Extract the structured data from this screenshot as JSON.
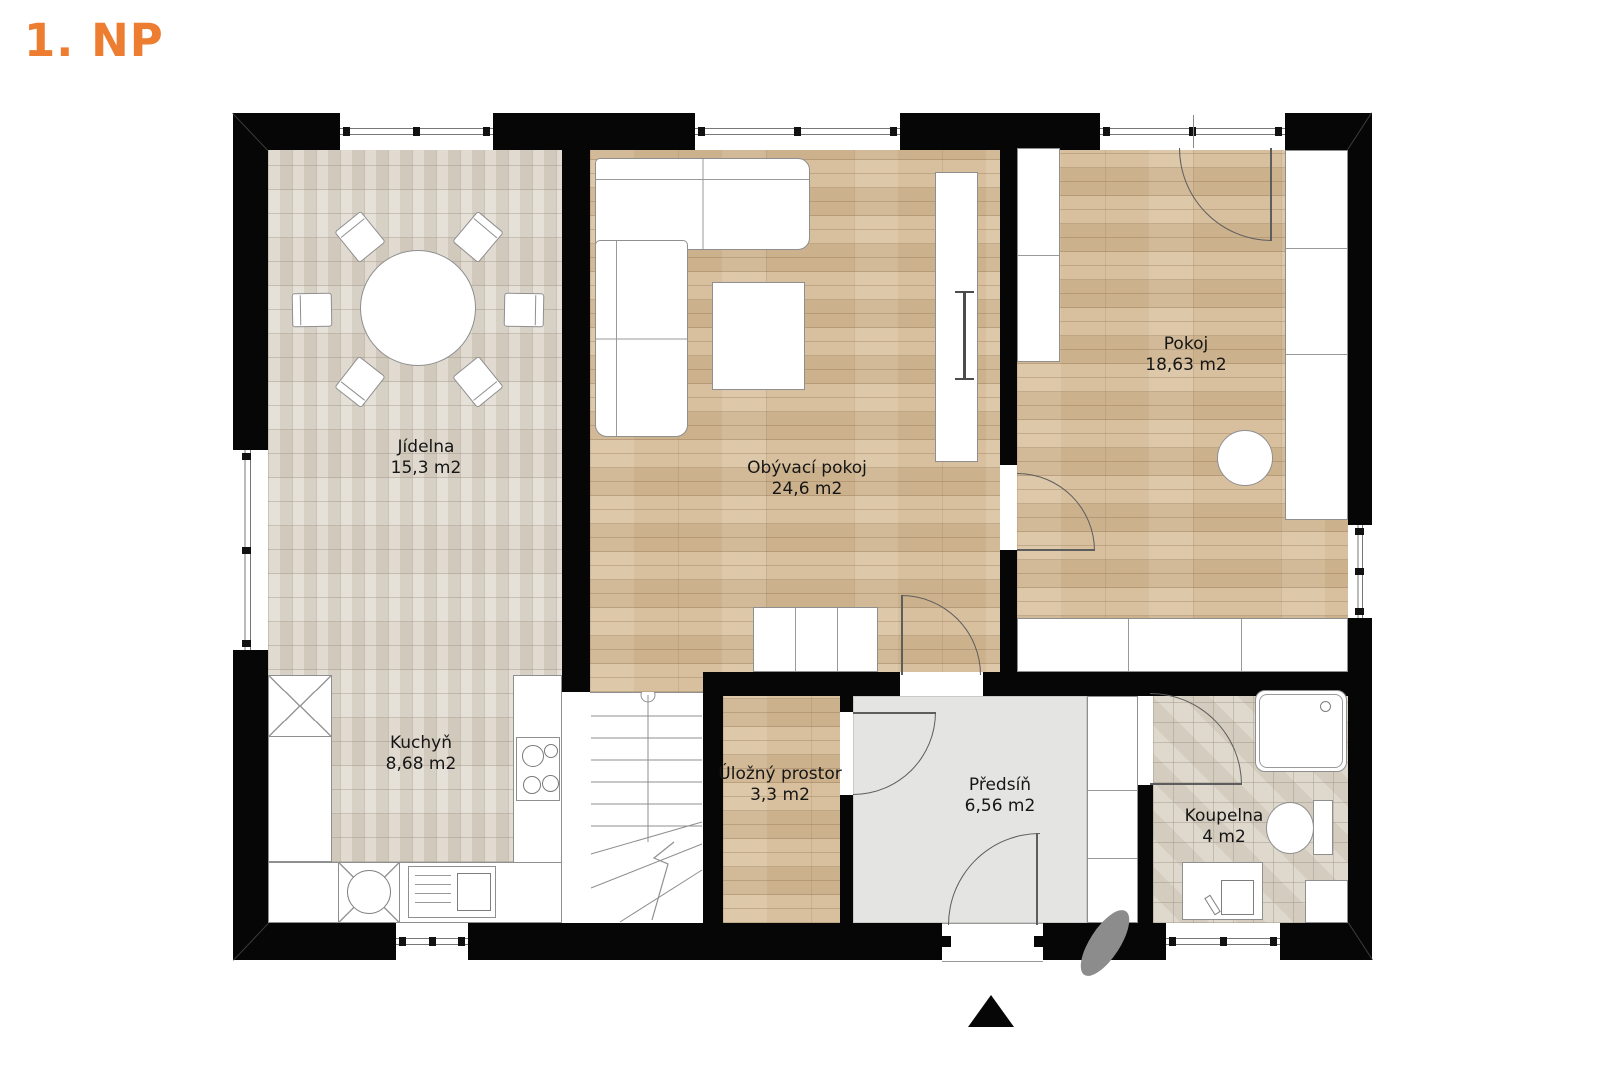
{
  "title": "1. NP",
  "rooms": [
    {
      "name": "Jídelna",
      "area": "15,3 m2"
    },
    {
      "name": "Kuchyň",
      "area": "8,68 m2"
    },
    {
      "name": "Obývací pokoj",
      "area": "24,6 m2"
    },
    {
      "name": "Pokoj",
      "area": "18,63 m2"
    },
    {
      "name": "Úložný prostor",
      "area": "3,3 m2"
    },
    {
      "name": "Předsíň",
      "area": "6,56 m2"
    },
    {
      "name": "Koupelna",
      "area": "4 m2"
    }
  ],
  "compass": {
    "icon": "north-arrow",
    "direction": "up"
  },
  "colors": {
    "accent": "#ED7D31",
    "wall": "#060606",
    "wood_floor": "#d8bf9b",
    "tile_floor": "#dcd6cb",
    "bath_floor": "#d9d2c5",
    "hall_floor": "#e4e4e2",
    "shadow": "#8c8c8c"
  }
}
